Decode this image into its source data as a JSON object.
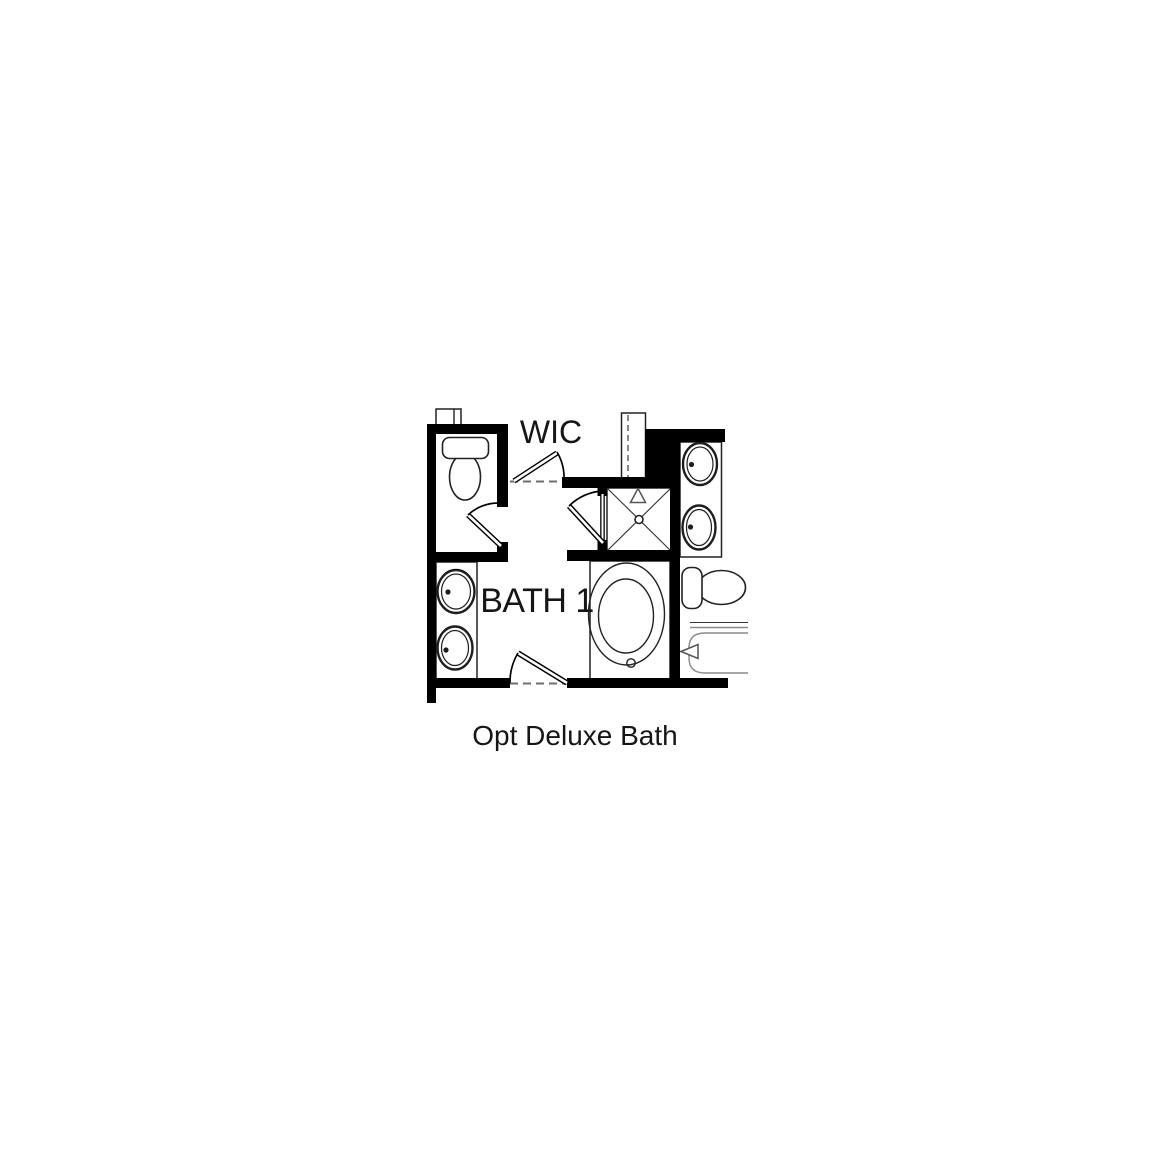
{
  "colors": {
    "wall": "#000000",
    "line": "#222222",
    "accent": "#8a8a8a",
    "bg": "#ffffff"
  },
  "rooms": {
    "wic": {
      "label": "WIC"
    },
    "bath1": {
      "label": "BATH 1"
    }
  },
  "caption": "Opt Deluxe Bath",
  "fixtures": [
    "toilet",
    "double-sink-vanity-left",
    "double-sink-vanity-right",
    "shower-with-glass-door",
    "oval-bathtub",
    "toilet-right",
    "tub-shower-right"
  ]
}
